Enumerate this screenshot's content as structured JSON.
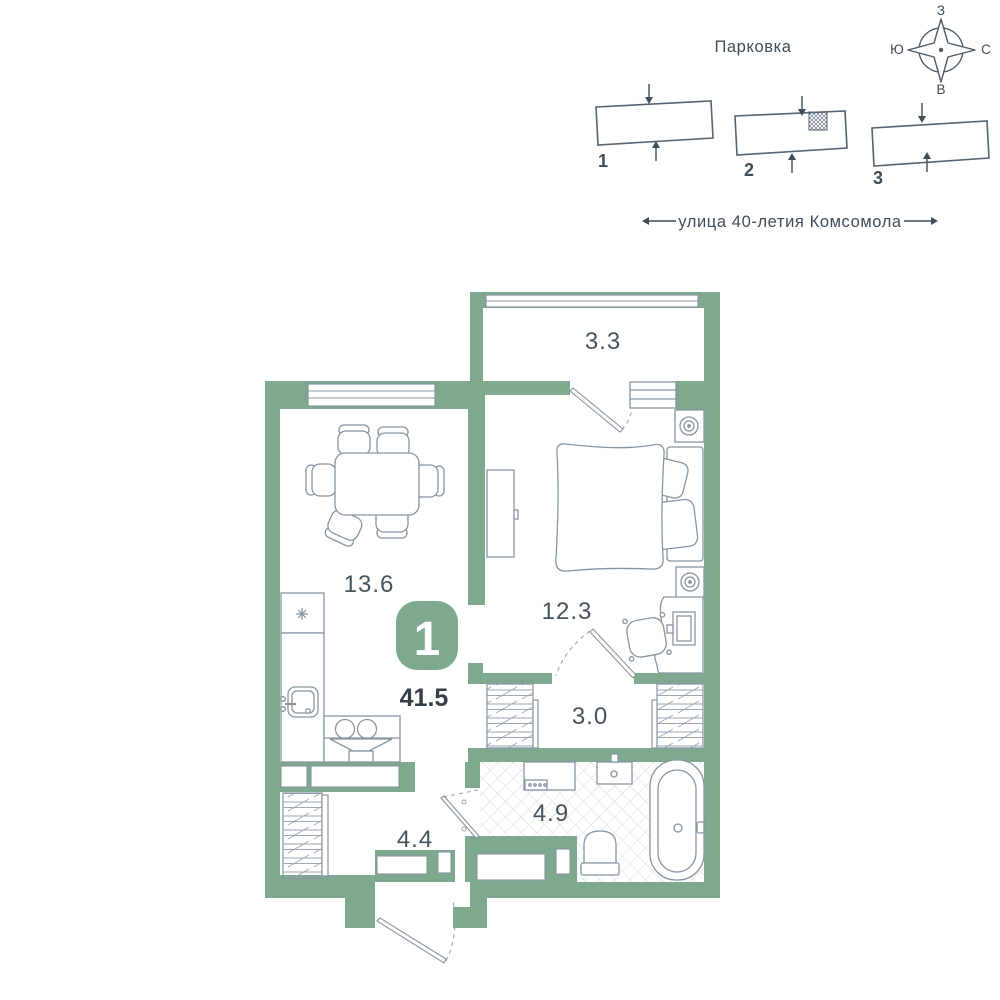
{
  "site": {
    "parking_title": "Парковка",
    "street": "улица 40-летия Комсомола",
    "compass": {
      "top": "З",
      "left": "Ю",
      "right": "С",
      "bottom": "В"
    },
    "buildings": [
      {
        "label": "1"
      },
      {
        "label": "2"
      },
      {
        "label": "3"
      }
    ]
  },
  "apartment": {
    "badge_number": "1",
    "total_area": "41.5",
    "areas": {
      "balcony": "3.3",
      "kitchen_living": "13.6",
      "bedroom": "12.3",
      "hallway": "3.0",
      "bathroom": "4.9",
      "entry": "4.4"
    }
  },
  "colors": {
    "wall_green": "#7da98f",
    "line_gray": "#8795a3",
    "text_dark": "#3f4c59",
    "area_text": "#46545f"
  }
}
